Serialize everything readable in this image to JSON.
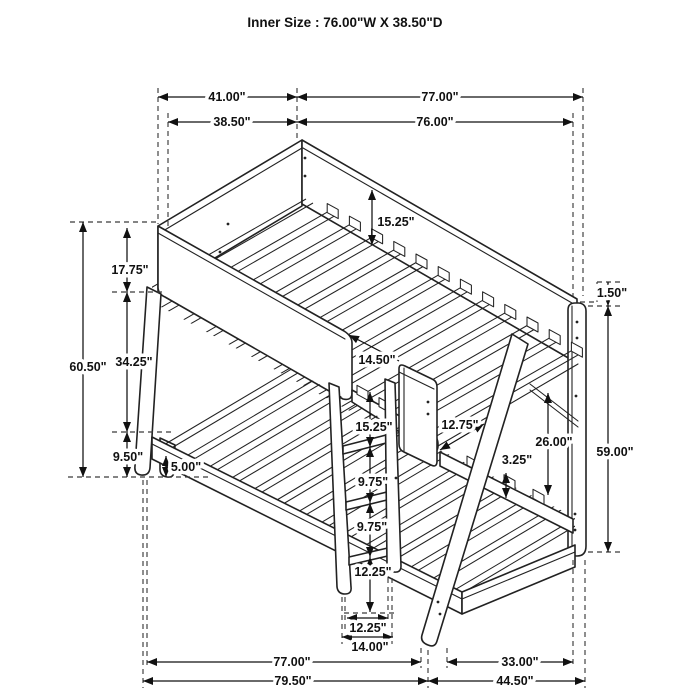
{
  "title": "Inner Size : 76.00\"W X  38.50\"D",
  "dims": {
    "top_depth_outer": "41.00\"",
    "top_width_outer": "77.00\"",
    "top_depth_inner": "38.50\"",
    "top_width_inner": "76.00\"",
    "total_height": "60.50\"",
    "upper_rail_height": "17.75\"",
    "bunk_gap": "34.25\"",
    "lower_frame_height": "9.50\"",
    "floor_clearance": "5.00\"",
    "upper_rail_to_slats": "15.25\"",
    "access_opening": "14.50\"",
    "ladder_top_spacing": "15.25\"",
    "rung_spacing_a": "9.75\"",
    "rung_spacing_b": "9.75\"",
    "ladder_bottom_height": "12.25\"",
    "ladder_inner_width": "12.25\"",
    "ladder_outer_width": "14.00\"",
    "headboard_to_leg": "12.75\"",
    "slat_bracket_height": "3.25\"",
    "lower_clearance": "26.00\"",
    "post_top_offset": "1.50\"",
    "post_height": "59.00\"",
    "bottom_width_inner": "77.00\"",
    "bottom_depth_inner": "33.00\"",
    "bottom_width_outer": "79.50\"",
    "bottom_depth_outer": "44.50\""
  }
}
